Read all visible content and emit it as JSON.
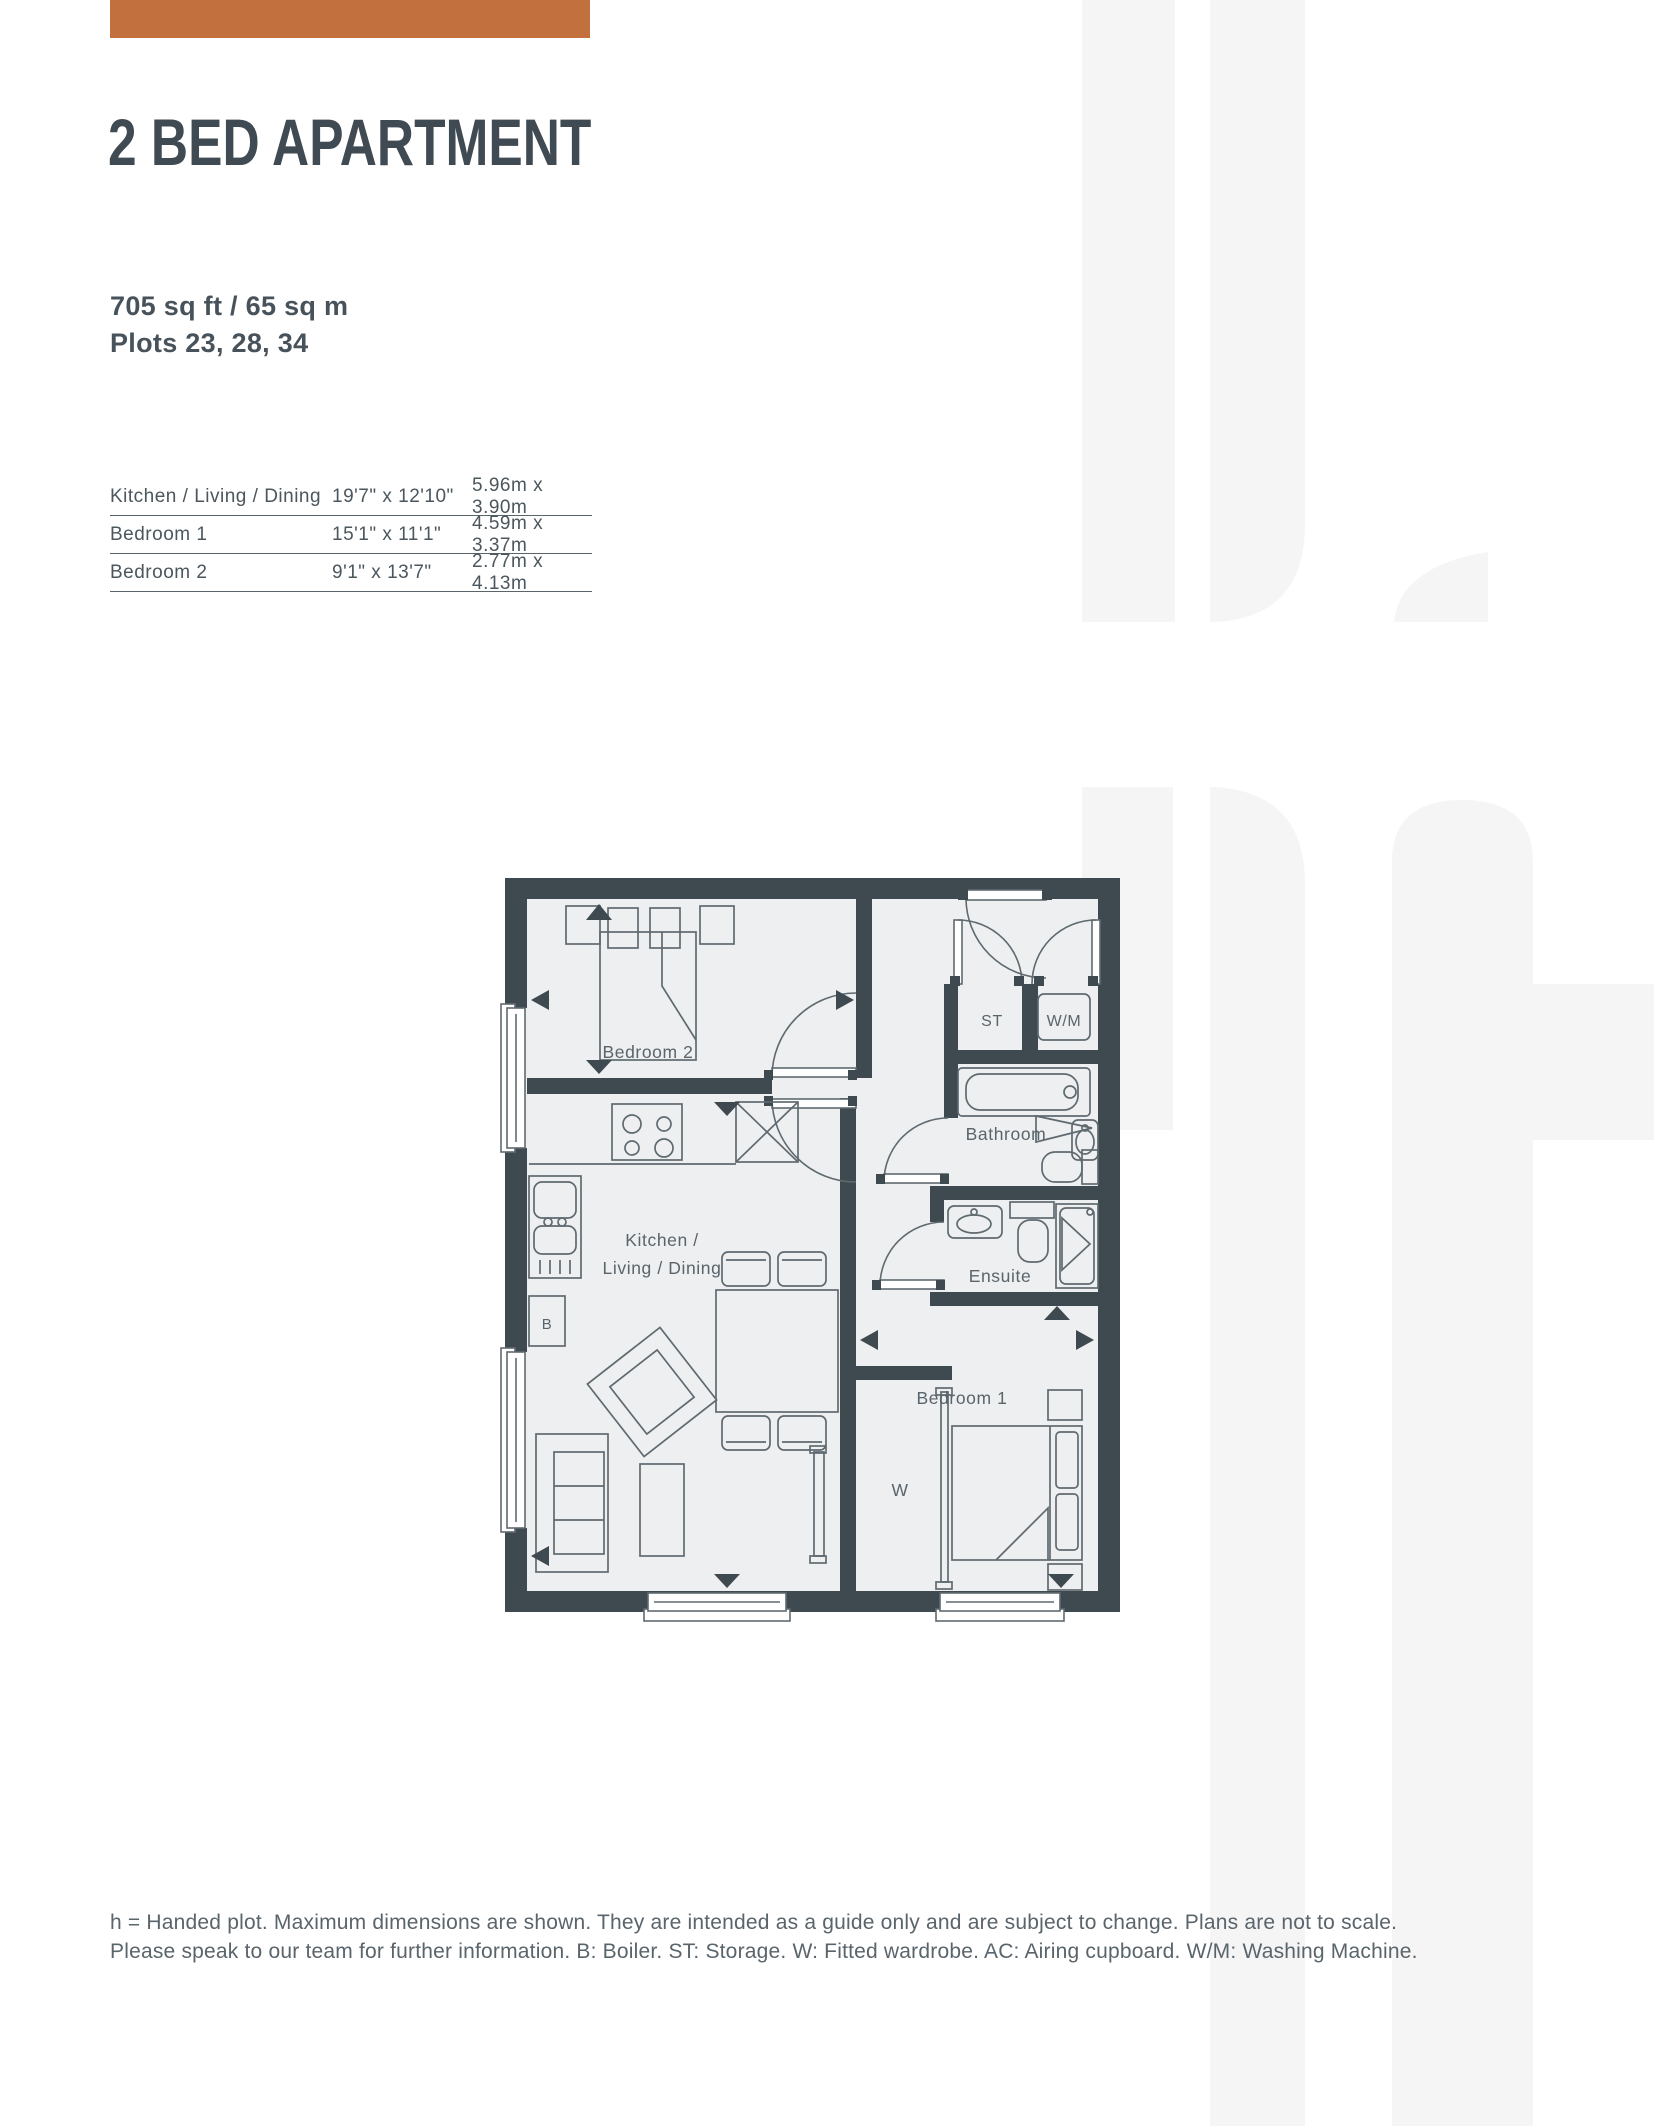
{
  "page": {
    "accent_color": "#c1703e",
    "title_color": "#3f4a52",
    "wall_color": "#3e4950",
    "floor_color": "#edeff0",
    "furniture_line_color": "#5f6a70",
    "watermark_color": "#f5f5f6"
  },
  "header": {
    "title": "2 BED APARTMENT",
    "area": "705 sq ft / 65 sq m",
    "plots": "Plots 23, 28, 34"
  },
  "dimensions_table": {
    "rows": [
      {
        "room": "Kitchen / Living / Dining",
        "imperial": "19'7\" x 12'10\"",
        "metric": "5.96m x 3.90m"
      },
      {
        "room": "Bedroom 1",
        "imperial": "15'1\" x 11'1\"",
        "metric": "4.59m x 3.37m"
      },
      {
        "room": "Bedroom 2",
        "imperial": "9'1\" x 13'7\"",
        "metric": "2.77m x 4.13m"
      }
    ]
  },
  "floorplan": {
    "labels": {
      "bedroom2": "Bedroom 2",
      "kitchen_line1": "Kitchen /",
      "kitchen_line2": "Living / Dining",
      "bathroom": "Bathroom",
      "ensuite": "Ensuite",
      "bedroom1": "Bedroom 1",
      "storage": "ST",
      "washing_machine": "W/M",
      "wardrobe": "W",
      "boiler": "B"
    }
  },
  "footer": {
    "line1": "h = Handed plot. Maximum dimensions are shown. They are intended as a guide only and are subject to change. Plans are not to scale.",
    "line2": "Please speak to our team for further information. B: Boiler. ST: Storage. W: Fitted wardrobe. AC: Airing cupboard. W/M: Washing Machine."
  }
}
